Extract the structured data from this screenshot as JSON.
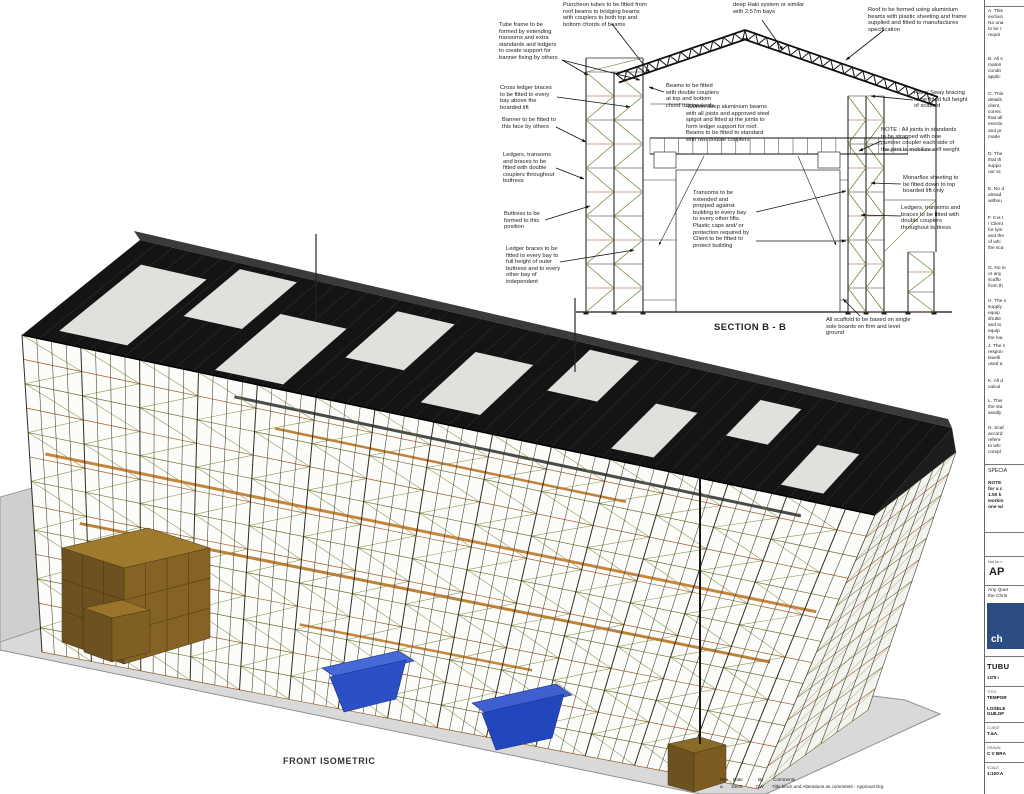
{
  "drawing": {
    "section_title": "SECTION B - B",
    "iso_title": "FRONT ISOMETRIC",
    "annotations": {
      "tube_frame": "Tube frame to be formed by extending transoms and extra standards and ledgers to create support for banner fixing by others",
      "puncheon": "Puncheon tubes to be fitted from roof beams to bridging beams with couplers to both top and bottom chords of beams",
      "haki": "deep Haki system or similar with 2.57m bays",
      "roof_formed": "Roof to be formed using aluminium beams with plastic sheeting and frame supplied and fitted to manufactures specification",
      "cross_ledger": "Cross ledger braces to be fitted to every bay above the boarded lift",
      "banner_face": "Banner to be fitted to this face by others",
      "ledgers_left": "Ledgers, transoms and braces to be fitted with double couplers throughout buttress",
      "buttress": "Buttress to be formed to this position",
      "ledger_braces": "Ledger braces to be fitted to every bay to full height of outer buttress and to every other bay of independent",
      "beams_fitted": "Beams to be fitted with double couplers at top and bottom chord to standards",
      "alu_beams": "450mm deep aluminium beams with all joists and approved steel spigot and fitted at the joints to form ledger support for roof. Beams to be fitted to standard with two double couplers",
      "face_sway": "Face/ Sway bracing to be fitted full height of scaffold",
      "note_joints": "NOTE : All joints in standards to be strapped with one number coupler each side of the joint to mobilize self weight",
      "monarflex": "Monarflex sheeting to be fitted down to top boarded lift only",
      "ledgers_right": "Ledgers, transoms and braces to be fitted with double couplers throughout buttress",
      "transoms": "Transoms to be extended and propped against building to every bay to every other lifts. Plastic caps and/ or protection required by Client to be fitted to protect building",
      "sole_boards": "All scaffold to be based on single sole boards on firm and level ground"
    }
  },
  "sidebar": {
    "notes": [
      "A. This\nexclusi\nNo una\nto be r\nrequir",
      "B. All s\nmateri\ncondit\napplic",
      "C. This\ndetails\nclient,\ncorrec\nthat all\nerectio\nand pr\nmade",
      "D. The\nthat th\nsuppo\nour sc",
      "E. No d\nalread\nwithou",
      "F. It is t\n/ Client\nfor tyin\nand the\nof whi\nthe sca",
      "G. No lo\nor any\nscaffo\nfrom th",
      "H. The s\nsupply\nequip\nshutte\nand to\nequip\nthe loa",
      "J. The s\nrespon\nlevelli\nused a",
      "K. All d\ncalcul",
      "L. This\nthe sta\naxially",
      "N. Scaf\naccord\nrefere\nto whi\ncompl"
    ],
    "special_header": "SPECIA",
    "special_note": "NOTE\nfor a c\n1.50 k\nworkin\none wi",
    "approval_small": "Not for c",
    "approval_big": "AP",
    "queries": "Any Quer\nthe Chris",
    "logo_text": "ch",
    "titleblock": {
      "company": "TUBU",
      "company_sub": "1378 I",
      "rows": [
        {
          "label": "TITLE",
          "value": "TEMPOR"
        },
        {
          "label": "",
          "value": "LOSELE\nGUILDF"
        },
        {
          "label": "CLIENT",
          "value": "T.&A."
        },
        {
          "label": "DRAWN",
          "value": "C V BRA"
        },
        {
          "label": "SCALE",
          "value": "1:100 A"
        }
      ]
    }
  },
  "revision": {
    "headers": {
      "rev": "Rev",
      "date": "Date",
      "by": "By",
      "comments": "Comments"
    },
    "row": {
      "rev": "a",
      "date": "10/05",
      "by": "CW",
      "comments": "Title block and Alterations as comments - Approval Drg"
    }
  },
  "colors": {
    "scaffold_green": "#839141",
    "ledger_orange": "#9a5c28",
    "roof_black": "#141414",
    "skip_blue": "#2b50c6",
    "crate_brown": "#6e5120",
    "logo_navy": "#2b4d82"
  }
}
